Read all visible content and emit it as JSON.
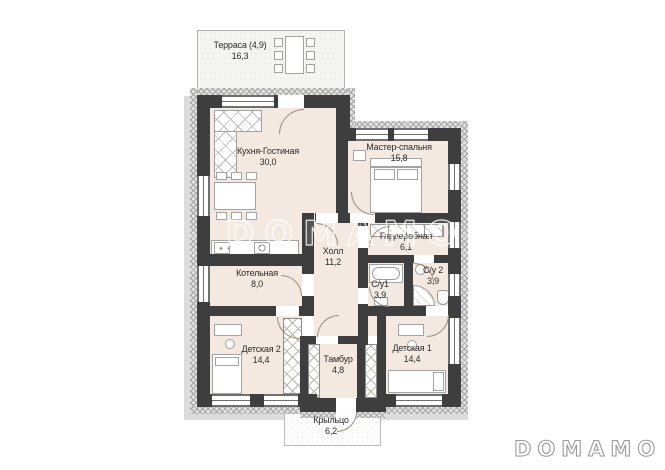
{
  "brand": {
    "watermark": "DOMAMO",
    "logo": "DOMAMO"
  },
  "rooms": {
    "terrace": {
      "name": "Терраса (4,9)",
      "area": "16,3"
    },
    "kitchen_living": {
      "name": "Кухня-Гостиная",
      "area": "30,0"
    },
    "master_bedroom": {
      "name": "Мастер-спальня",
      "area": "15,8"
    },
    "wardrobe": {
      "name": "Гардеробная",
      "area": "6,1"
    },
    "hall": {
      "name": "Холл",
      "area": "11,2"
    },
    "boiler": {
      "name": "Котельная",
      "area": "8,0"
    },
    "bath1": {
      "name": "С/у1",
      "area": "3,9"
    },
    "bath2": {
      "name": "С/у 2",
      "area": "3,9"
    },
    "kids2": {
      "name": "Детская 2",
      "area": "14,4"
    },
    "vestibule": {
      "name": "Тамбур",
      "area": "4,8"
    },
    "kids1": {
      "name": "Детская 1",
      "area": "14,4"
    },
    "porch": {
      "name": "Крыльцо",
      "area": "6,2"
    }
  },
  "colors": {
    "wall": "#3e3e3e",
    "floor": "#f4e9e0",
    "insulation": "#c9c9c9",
    "logo_gray": "#9a9a9a"
  }
}
